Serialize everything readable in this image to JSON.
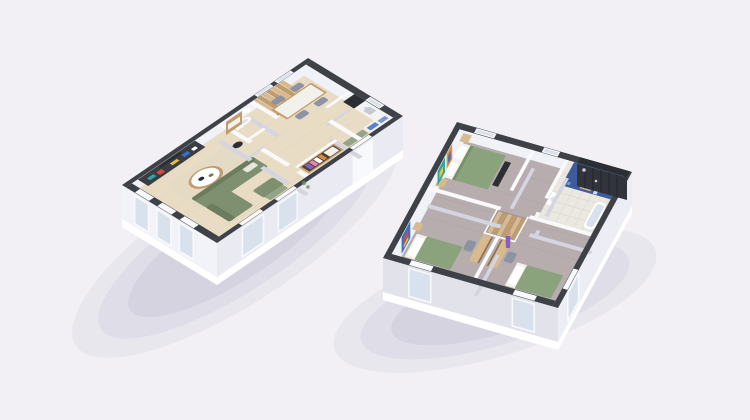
{
  "scene": {
    "type": "isometric-3d-floorplan-render",
    "background": "#f2f0f5",
    "buildings": [
      {
        "id": "ground-floor",
        "rooms": [
          "living-room",
          "dining-area",
          "kitchen",
          "wc",
          "entry-hallway",
          "staircase"
        ],
        "furniture": [
          "media-shelf-unit",
          "sofa-sectional",
          "armchair",
          "coffee-table",
          "floor-lamp",
          "dining-table",
          "dining-chairs",
          "fridge",
          "kitchen-counter",
          "sink",
          "toilet",
          "wardrobe-with-clothes",
          "entry-mat",
          "area-rug",
          "picture-frame"
        ]
      },
      {
        "id": "upper-floor",
        "rooms": [
          "bedroom-main",
          "bedroom-left",
          "bedroom-bottom",
          "bathroom",
          "landing",
          "staircase"
        ],
        "furniture": [
          "double-bed",
          "single-bed-left",
          "single-bed-bottom",
          "nightstands",
          "foot-bench",
          "desk-pair",
          "desk-chairs",
          "bathtub",
          "shower-wall",
          "vanity-sink",
          "towel-ladder",
          "wall-art",
          "person-figure"
        ]
      }
    ],
    "palette": {
      "bg": "#f2f0f5",
      "shadow": "#6a6a8e",
      "plinth": "#ffffff",
      "faceA": "#f2f3f8",
      "faceB": "#e9eaf2",
      "faceC": "#e2e2eb",
      "faceD": "#edeef5",
      "wallDark": "#3e4147",
      "wallDark2": "#2b2e33",
      "capWhite": "#fafafd",
      "wallFace": "#d4d5e0",
      "innerFace": "#f0f2f8",
      "glass": "#d9e2ec",
      "frameWhite": "#f8f9fc",
      "floorWood": "#e9dcc4",
      "floorWoodLine": "#dbcdb1",
      "floorGray": "#b7acae",
      "floorGrayLine": "#aba0a2",
      "tile": "#ebe8e1",
      "tileLine": "#d9d5cb",
      "tileBlue": "#3d5c9e",
      "tileBlueLight": "#7d97cc",
      "sofaGreen": "#7e9070",
      "sofaGreenDark": "#6b7d5e",
      "bedGreen": "#8ba37c",
      "bedGreenDark": "#79916b",
      "rugBeige": "#e4dac6",
      "rugGreen": "#93a487",
      "woodLight": "#d7ba8e",
      "wood": "#c19c6e",
      "woodDark": "#8a6f4e",
      "wardrobeInner": "#4a4036",
      "darkUnit": "#3a3d43",
      "grayChair": "#8d93a2",
      "counterWhite": "#f3f3f6",
      "sinkGray": "#c6cad2",
      "white": "#ffffff",
      "offWhite": "#f2f1ec",
      "accentRed": "#d94a3a",
      "accentYellow": "#e8c23a",
      "accentBlue": "#3a6fc4",
      "accentTeal": "#2fa6a0",
      "accentPurple": "#8b5fb8",
      "accentPink": "#e08ab0",
      "accentOrange": "#e08a3b",
      "metal": "#c7ccd4",
      "skin": "#c49a7c",
      "stripeDark": "#23262a",
      "shower": "#31343a",
      "well": "#9e9496"
    }
  }
}
